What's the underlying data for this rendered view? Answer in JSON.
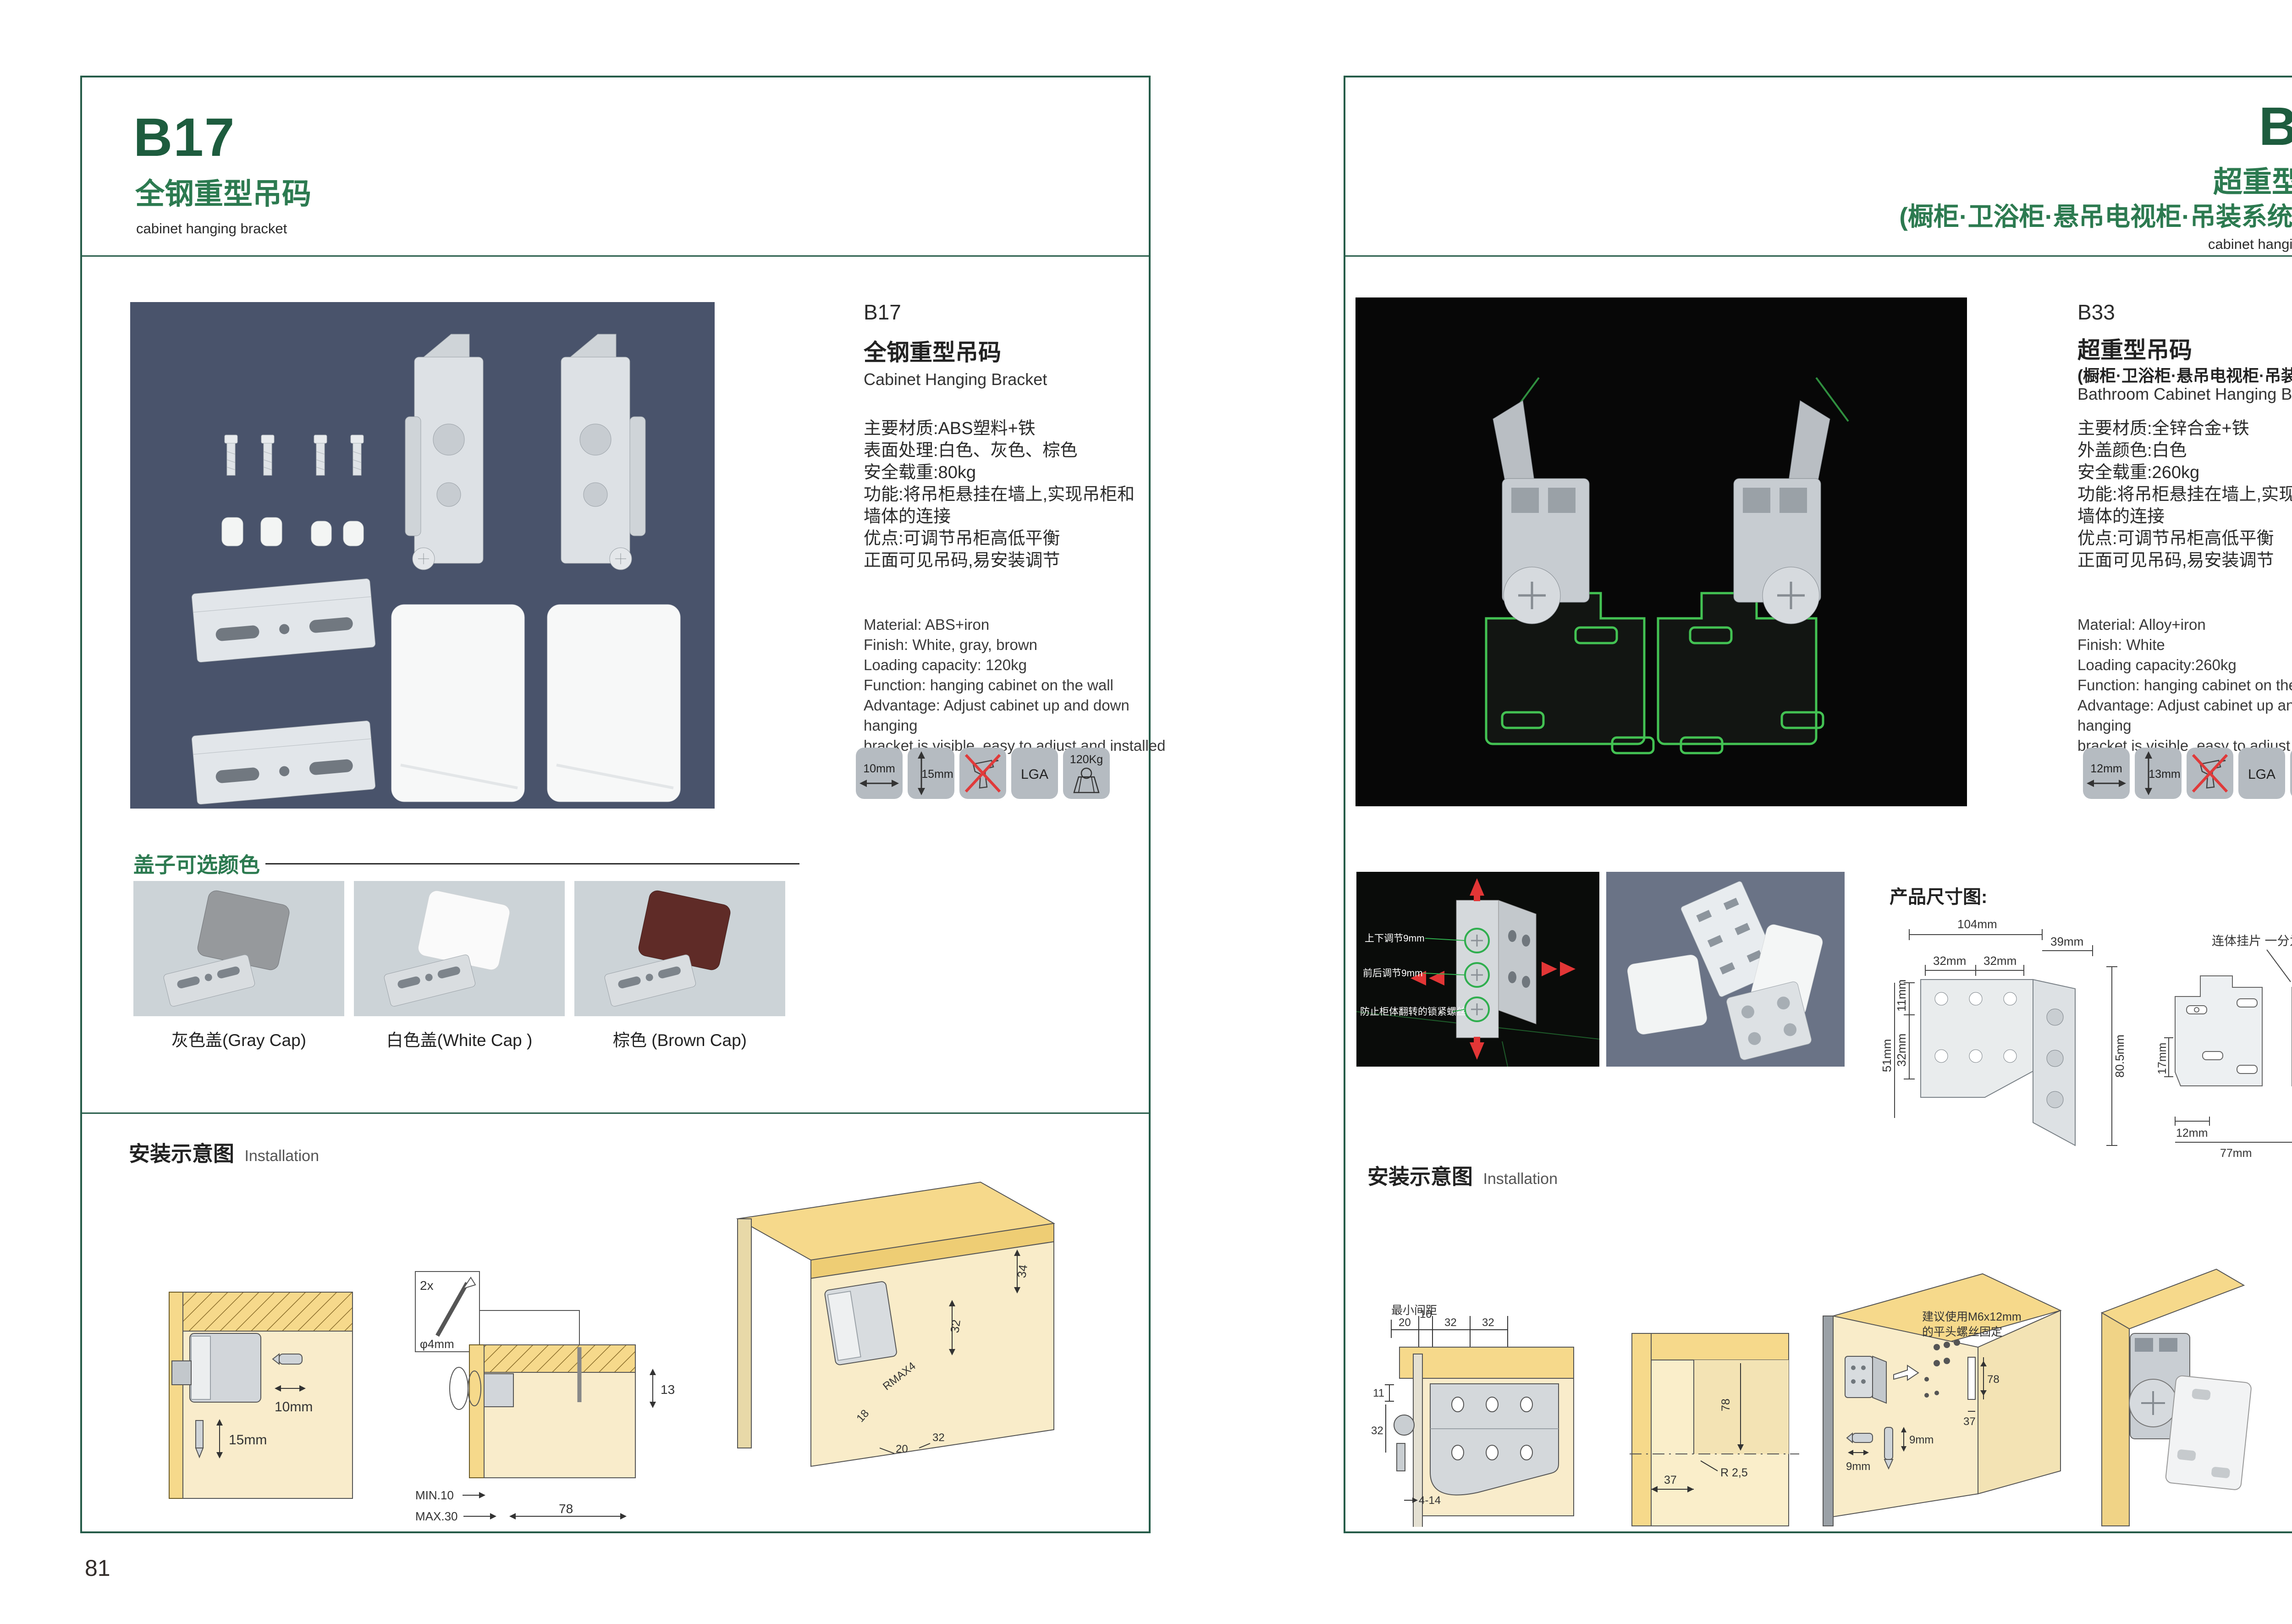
{
  "theme": {
    "accent_dark_green": "#1d5c3e",
    "accent_green": "#2c7a50",
    "frame_border": "#265c49",
    "icon_background": "#b5bbc1",
    "photo_bg_left": "#49536b",
    "photo_bg_right": "#070707",
    "wood_yellow": "#f6d98b",
    "wood_light": "#f9eccb",
    "red_arrow": "#e03a3a",
    "green_highlight": "#43c253"
  },
  "page_left": {
    "page_number": "81",
    "header": {
      "code": "B17",
      "title_cn": "全钢重型吊码",
      "subtitle_en": "cabinet hanging bracket"
    },
    "detail": {
      "code": "B17",
      "name_cn": "全钢重型吊码",
      "name_en": "Cabinet Hanging Bracket",
      "specs_cn": [
        "主要材质:ABS塑料+铁",
        "表面处理:白色、灰色、棕色",
        "安全载重:80kg",
        "功能:将吊柜悬挂在墙上,实现吊柜和",
        "墙体的连接",
        "优点:可调节吊柜高低平衡",
        "正面可见吊码,易安装调节"
      ],
      "specs_en": [
        "Material: ABS+iron",
        "Finish: White, gray, brown",
        "Loading capacity: 120kg",
        "Function: hanging cabinet on the wall",
        "Advantage: Adjust cabinet up and down hanging",
        "bracket is visible, easy to adjust and installed"
      ],
      "icons": {
        "width": "10mm",
        "height": "15mm",
        "cert": "LGA",
        "load": "120Kg"
      }
    },
    "colors_section": {
      "title": "盖子可选颜色",
      "options": [
        {
          "caption": "灰色盖(Gray Cap)",
          "color": "#96999c"
        },
        {
          "caption": "白色盖(White Cap )",
          "color": "#fafafa"
        },
        {
          "caption": "棕色 (Brown Cap)",
          "color": "#5f2b27"
        }
      ]
    },
    "installation": {
      "title_cn": "安装示意图",
      "title_en": "Installation",
      "d1": {
        "dim_w": "10mm",
        "dim_h": "15mm"
      },
      "d2": {
        "qty": "2x",
        "dia": "φ4mm",
        "dim13": "13",
        "min": "MIN.10",
        "max": "MAX.30",
        "dim78": "78"
      },
      "d3": {
        "dim34": "34",
        "dim32a": "32",
        "rmax": "RMAX4",
        "dim18": "18",
        "dim20": "20",
        "dim32b": "32"
      }
    }
  },
  "page_right": {
    "page_number": "82",
    "header": {
      "code": "B33",
      "title_cn": "超重型吊码",
      "title_cn_sub": "(橱柜·卫浴柜·悬吊电视柜·吊装系统 专用)",
      "subtitle_en": "cabinet hanging bracket"
    },
    "detail": {
      "code": "B33",
      "name_cn": "超重型吊码",
      "name_cn_sub": "(橱柜·卫浴柜·悬吊电视柜·吊装系统 专用)",
      "name_en": "Bathroom Cabinet Hanging Bracket",
      "specs_cn": [
        "主要材质:全锌合金+铁",
        "外盖颜色:白色",
        "安全载重:260kg",
        "功能:将吊柜悬挂在墙上,实现吊柜和",
        "墙体的连接",
        "优点:可调节吊柜高低平衡",
        "正面可见吊码,易安装调节"
      ],
      "specs_en": [
        "Material: Alloy+iron",
        "Finish: White",
        "Loading capacity:260kg",
        "Function: hanging cabinet on the wall",
        "Advantage: Adjust cabinet up and down hanging",
        "bracket is visible, easy to adjust and installed"
      ],
      "icons": {
        "width": "12mm",
        "height": "13mm",
        "cert": "LGA",
        "load": "260Kg"
      }
    },
    "features": {
      "labels": [
        "上下调节9mm",
        "前后调节9mm",
        "防止柜体翻转的锁紧螺丝"
      ]
    },
    "dimensions": {
      "title": "产品尺寸图:",
      "bracket": {
        "w": "104mm",
        "depth": "39mm",
        "s1": "32mm",
        "s2": "32mm",
        "t": "11mm",
        "v": "32mm",
        "h_left": "51mm",
        "h_right": "80.5mm"
      },
      "plate": {
        "note": "连体挂片 一分为二",
        "top": "55mm",
        "right1": "39mm",
        "right2": "55mm",
        "left": "17mm",
        "b1": "12mm",
        "b2": "77mm",
        "b3": "63mm",
        "r8": "8mm"
      }
    },
    "installation": {
      "title_cn": "安装示意图",
      "title_en": "Installation",
      "d1": {
        "min_label": "最小间距",
        "d20": "20",
        "d10": "10",
        "d32a": "32",
        "d32b": "32",
        "d11": "11",
        "d32c": "32",
        "d414": "4-14"
      },
      "d2": {
        "d78": "78",
        "r": "R 2,5",
        "d37": "37"
      },
      "d3": {
        "note1": "建议使用M6x12mm",
        "note2": "的平头螺丝固定",
        "d78": "78",
        "d37": "37",
        "d9a": "9mm",
        "d9b": "9mm"
      }
    }
  }
}
